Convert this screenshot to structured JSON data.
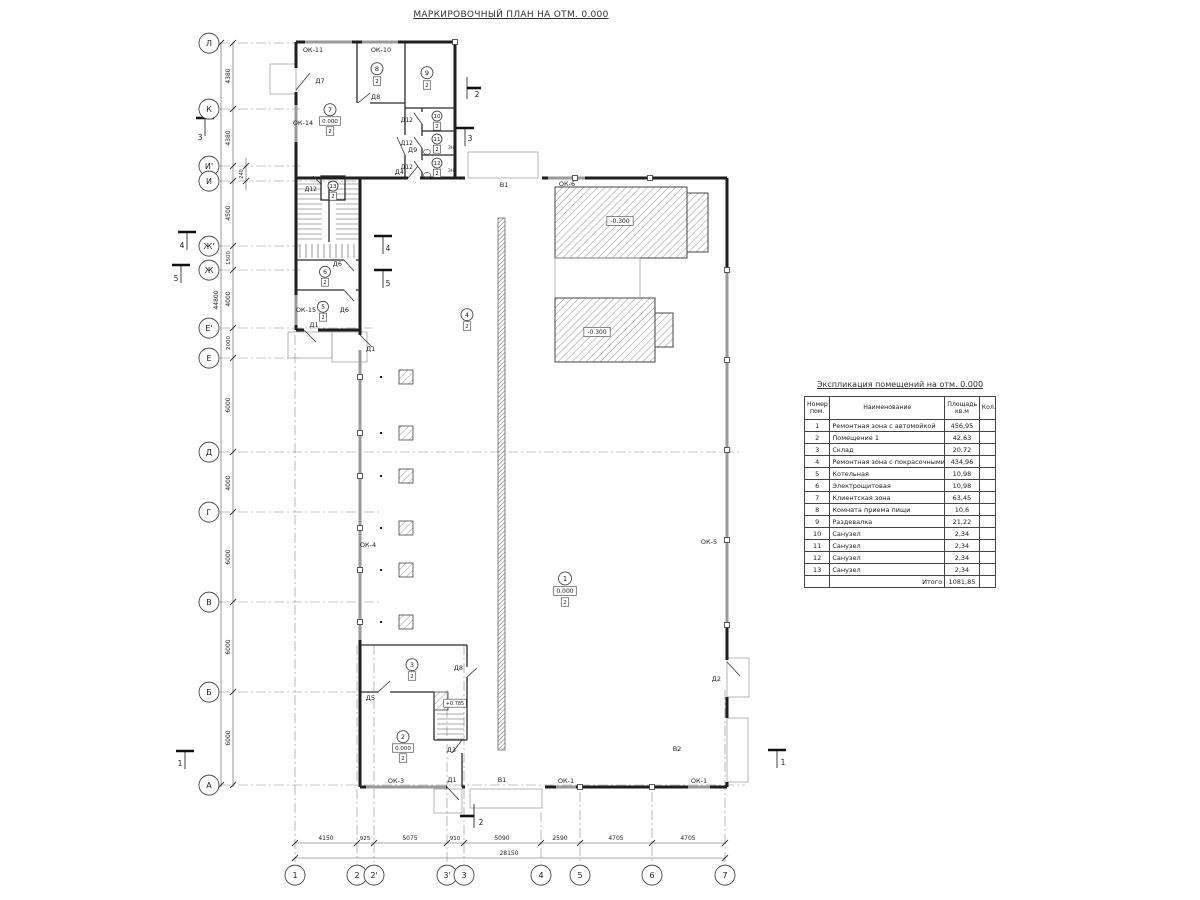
{
  "title": "МАРКИРОВОЧНЫЙ ПЛАН НА ОТМ. 0.000",
  "schedule": {
    "title": "Экспликация помещений на отм. 0.000",
    "headers": {
      "num1": "Номер",
      "num2": "пом.",
      "name": "Наименование",
      "area1": "Площадь",
      "area2": "кв.м",
      "qty": "Кол."
    },
    "rows": [
      {
        "num": "1",
        "name": "Ремонтная зона с автомойкой",
        "area": "456,95",
        "qty": ""
      },
      {
        "num": "2",
        "name": "Помещение 1",
        "area": "42,63",
        "qty": ""
      },
      {
        "num": "3",
        "name": "Склад",
        "area": "20,72",
        "qty": ""
      },
      {
        "num": "4",
        "name": "Ремонтная зона с покрасочными камерами",
        "area": "434,96",
        "qty": ""
      },
      {
        "num": "5",
        "name": "Котельная",
        "area": "10,98",
        "qty": ""
      },
      {
        "num": "6",
        "name": "Электрощитовая",
        "area": "10,98",
        "qty": ""
      },
      {
        "num": "7",
        "name": "Клиентская зона",
        "area": "63,45",
        "qty": ""
      },
      {
        "num": "8",
        "name": "Комната приема пищи",
        "area": "10,6",
        "qty": ""
      },
      {
        "num": "9",
        "name": "Раздевалка",
        "area": "21,22",
        "qty": ""
      },
      {
        "num": "10",
        "name": "Санузел",
        "area": "2,34",
        "qty": ""
      },
      {
        "num": "11",
        "name": "Санузел",
        "area": "2,34",
        "qty": ""
      },
      {
        "num": "12",
        "name": "Санузел",
        "area": "2,34",
        "qty": ""
      },
      {
        "num": "13",
        "name": "Санузел",
        "area": "2,34",
        "qty": ""
      }
    ],
    "total_label": "Итого",
    "total_value": "1081,85"
  },
  "plan": {
    "colors": {
      "wall": "#1f1f1f",
      "window": "#9a9a9a",
      "hatch": "#777"
    },
    "labels": [
      {
        "n": "axis-bubble-1",
        "t": "1",
        "x": 295,
        "y": 878,
        "r": 10,
        "fs": 8
      },
      {
        "n": "axis-bubble-2",
        "t": "2",
        "x": 357,
        "y": 878,
        "r": 10,
        "fs": 8
      },
      {
        "n": "axis-bubble-2p",
        "t": "2'",
        "x": 374,
        "y": 878,
        "r": 10,
        "fs": 8
      },
      {
        "n": "axis-bubble-3p",
        "t": "3'",
        "x": 447,
        "y": 878,
        "r": 10,
        "fs": 8
      },
      {
        "n": "axis-bubble-3",
        "t": "3",
        "x": 464,
        "y": 878,
        "r": 10,
        "fs": 8
      },
      {
        "n": "axis-bubble-4",
        "t": "4",
        "x": 541,
        "y": 878,
        "r": 10,
        "fs": 8
      },
      {
        "n": "axis-bubble-5",
        "t": "5",
        "x": 580,
        "y": 878,
        "r": 10,
        "fs": 8
      },
      {
        "n": "axis-bubble-6",
        "t": "6",
        "x": 652,
        "y": 878,
        "r": 10,
        "fs": 8
      },
      {
        "n": "axis-bubble-7",
        "t": "7",
        "x": 725,
        "y": 878,
        "r": 10,
        "fs": 8
      },
      {
        "n": "axis-bubble-L",
        "t": "Л",
        "x": 209,
        "y": 46,
        "r": 10,
        "fs": 8
      },
      {
        "n": "axis-bubble-K",
        "t": "К",
        "x": 209,
        "y": 112,
        "r": 10,
        "fs": 8
      },
      {
        "n": "axis-bubble-Ip",
        "t": "И'",
        "x": 209,
        "y": 169,
        "r": 10,
        "fs": 8
      },
      {
        "n": "axis-bubble-I",
        "t": "И",
        "x": 209,
        "y": 184,
        "r": 10,
        "fs": 8
      },
      {
        "n": "axis-bubble-Zhp",
        "t": "Ж'",
        "x": 209,
        "y": 249,
        "r": 10,
        "fs": 8
      },
      {
        "n": "axis-bubble-Zh",
        "t": "Ж",
        "x": 209,
        "y": 273,
        "r": 10,
        "fs": 8
      },
      {
        "n": "axis-bubble-Ep",
        "t": "Е'",
        "x": 209,
        "y": 331,
        "r": 10,
        "fs": 8
      },
      {
        "n": "axis-bubble-E",
        "t": "Е",
        "x": 209,
        "y": 361,
        "r": 10,
        "fs": 8
      },
      {
        "n": "axis-bubble-D",
        "t": "Д",
        "x": 209,
        "y": 455,
        "r": 10,
        "fs": 8
      },
      {
        "n": "axis-bubble-G",
        "t": "Г",
        "x": 209,
        "y": 515,
        "r": 10,
        "fs": 8
      },
      {
        "n": "axis-bubble-V",
        "t": "В",
        "x": 209,
        "y": 605,
        "r": 10,
        "fs": 8
      },
      {
        "n": "axis-bubble-B",
        "t": "Б",
        "x": 209,
        "y": 695,
        "r": 10,
        "fs": 8
      },
      {
        "n": "axis-bubble-A",
        "t": "А",
        "x": 209,
        "y": 788,
        "r": 10,
        "fs": 8
      },
      {
        "n": "dim-bottom",
        "t": "4150",
        "x": 326,
        "y": 840,
        "fs": 6
      },
      {
        "n": "dim-bottom",
        "t": "925",
        "x": 365,
        "y": 840,
        "fs": 5.5
      },
      {
        "n": "dim-bottom",
        "t": "5075",
        "x": 410,
        "y": 840,
        "fs": 6
      },
      {
        "n": "dim-bottom",
        "t": "910",
        "x": 455,
        "y": 840,
        "fs": 5.5
      },
      {
        "n": "dim-bottom",
        "t": "5090",
        "x": 502,
        "y": 840,
        "fs": 6
      },
      {
        "n": "dim-bottom",
        "t": "2590",
        "x": 560,
        "y": 840,
        "fs": 6
      },
      {
        "n": "dim-bottom",
        "t": "4705",
        "x": 616,
        "y": 840,
        "fs": 6
      },
      {
        "n": "dim-bottom",
        "t": "4705",
        "x": 688,
        "y": 840,
        "fs": 6
      },
      {
        "n": "dim-bottom-total",
        "t": "28150",
        "x": 509,
        "y": 855,
        "fs": 6
      },
      {
        "n": "dim-left",
        "t": "4380",
        "x": 230,
        "y": 76,
        "fs": 6,
        "rot": -90
      },
      {
        "n": "dim-left",
        "t": "4380",
        "x": 230,
        "y": 138,
        "fs": 6,
        "rot": -90
      },
      {
        "n": "dim-left",
        "t": "240",
        "x": 243,
        "y": 174,
        "fs": 5,
        "rot": -90
      },
      {
        "n": "dim-left",
        "t": "4500",
        "x": 230,
        "y": 213,
        "fs": 6,
        "rot": -90
      },
      {
        "n": "dim-left",
        "t": "1500",
        "x": 230,
        "y": 258,
        "fs": 5.5,
        "rot": -90
      },
      {
        "n": "dim-left",
        "t": "4000",
        "x": 230,
        "y": 299,
        "fs": 6,
        "rot": -90
      },
      {
        "n": "dim-left",
        "t": "2000",
        "x": 230,
        "y": 343,
        "fs": 5.5,
        "rot": -90
      },
      {
        "n": "dim-left",
        "t": "6000",
        "x": 230,
        "y": 405,
        "fs": 6,
        "rot": -90
      },
      {
        "n": "dim-left",
        "t": "4000",
        "x": 230,
        "y": 483,
        "fs": 6,
        "rot": -90
      },
      {
        "n": "dim-left",
        "t": "6000",
        "x": 230,
        "y": 557,
        "fs": 6,
        "rot": -90
      },
      {
        "n": "dim-left",
        "t": "6000",
        "x": 230,
        "y": 647,
        "fs": 6,
        "rot": -90
      },
      {
        "n": "dim-left",
        "t": "6000",
        "x": 230,
        "y": 738,
        "fs": 6,
        "rot": -90
      },
      {
        "n": "dim-left-total",
        "t": "44800",
        "x": 218,
        "y": 300,
        "fs": 6,
        "rot": -90
      },
      {
        "n": "room-marker-7",
        "t": "7",
        "x": 330,
        "y": 112,
        "r": 6,
        "fs": 6.5
      },
      {
        "n": "elevation-mark",
        "t": "0.000",
        "x": 330,
        "y": 123,
        "b": 1,
        "fs": 5.5
      },
      {
        "n": "finish-tag",
        "t": "2",
        "x": 330,
        "y": 133,
        "b": 1,
        "fs": 5.5
      },
      {
        "n": "room-marker-8",
        "t": "8",
        "x": 377,
        "y": 71,
        "r": 6,
        "fs": 6.5
      },
      {
        "n": "finish-tag",
        "t": "2",
        "x": 377,
        "y": 83,
        "b": 1,
        "fs": 5.5
      },
      {
        "n": "room-marker-9",
        "t": "9",
        "x": 427,
        "y": 75,
        "r": 6,
        "fs": 6.5
      },
      {
        "n": "finish-tag",
        "t": "2",
        "x": 427,
        "y": 87,
        "b": 1,
        "fs": 5.5
      },
      {
        "n": "room-marker-10",
        "t": "10",
        "x": 437,
        "y": 118,
        "r": 5,
        "fs": 5.5
      },
      {
        "n": "finish-tag",
        "t": "2",
        "x": 437,
        "y": 128,
        "b": 1,
        "fs": 5
      },
      {
        "n": "room-marker-11",
        "t": "11",
        "x": 437,
        "y": 141,
        "r": 5,
        "fs": 5.5
      },
      {
        "n": "finish-tag",
        "t": "2",
        "x": 437,
        "y": 151,
        "b": 1,
        "fs": 5
      },
      {
        "n": "room-marker-12",
        "t": "12",
        "x": 437,
        "y": 165,
        "r": 5,
        "fs": 5.5
      },
      {
        "n": "finish-tag",
        "t": "2",
        "x": 437,
        "y": 175,
        "b": 1,
        "fs": 5
      },
      {
        "n": "room-marker-13",
        "t": "13",
        "x": 333,
        "y": 188,
        "r": 5,
        "fs": 5.5
      },
      {
        "n": "finish-tag",
        "t": "2",
        "x": 333,
        "y": 198,
        "b": 1,
        "fs": 5
      },
      {
        "n": "room-marker-6",
        "t": "6",
        "x": 325,
        "y": 274,
        "r": 5.5,
        "fs": 6
      },
      {
        "n": "finish-tag",
        "t": "2",
        "x": 325,
        "y": 284,
        "b": 1,
        "fs": 5
      },
      {
        "n": "room-marker-5",
        "t": "5",
        "x": 323,
        "y": 309,
        "r": 5.5,
        "fs": 6
      },
      {
        "n": "finish-tag",
        "t": "2",
        "x": 323,
        "y": 319,
        "b": 1,
        "fs": 5
      },
      {
        "n": "room-marker-4",
        "t": "4",
        "x": 467,
        "y": 317,
        "r": 6,
        "fs": 6.5
      },
      {
        "n": "finish-tag",
        "t": "2",
        "x": 467,
        "y": 328,
        "b": 1,
        "fs": 5.5
      },
      {
        "n": "room-marker-3",
        "t": "3",
        "x": 412,
        "y": 667,
        "r": 6,
        "fs": 6.5
      },
      {
        "n": "finish-tag",
        "t": "2",
        "x": 412,
        "y": 678,
        "b": 1,
        "fs": 5.5
      },
      {
        "n": "room-marker-2",
        "t": "2",
        "x": 403,
        "y": 739,
        "r": 6,
        "fs": 6.5
      },
      {
        "n": "elevation-mark",
        "t": "0.000",
        "x": 403,
        "y": 750,
        "b": 1,
        "fs": 5.5
      },
      {
        "n": "finish-tag",
        "t": "2",
        "x": 403,
        "y": 760,
        "b": 1,
        "fs": 5.5
      },
      {
        "n": "room-marker-1",
        "t": "1",
        "x": 565,
        "y": 581,
        "r": 6.5,
        "fs": 7
      },
      {
        "n": "elevation-mark",
        "t": "0.000",
        "x": 565,
        "y": 593,
        "b": 1,
        "fs": 6
      },
      {
        "n": "finish-tag",
        "t": "2",
        "x": 565,
        "y": 604,
        "b": 1,
        "fs": 5.5
      },
      {
        "n": "elevation-mark",
        "t": "-0.300",
        "x": 620,
        "y": 223,
        "b": 1,
        "fs": 6
      },
      {
        "n": "elevation-mark",
        "t": "-0.300",
        "x": 597,
        "y": 334,
        "b": 1,
        "fs": 6
      },
      {
        "n": "elevation-mark",
        "t": "+0.785",
        "x": 455,
        "y": 705,
        "b": 1,
        "fs": 5
      },
      {
        "n": "window-label",
        "t": "ОК-11",
        "x": 313,
        "y": 52,
        "fs": 6.5
      },
      {
        "n": "window-label",
        "t": "ОК-10",
        "x": 381,
        "y": 52,
        "fs": 6.5
      },
      {
        "n": "window-label",
        "t": "ОК-14",
        "x": 303,
        "y": 125,
        "fs": 6.5
      },
      {
        "n": "window-label",
        "t": "ОК-15",
        "x": 306,
        "y": 312,
        "fs": 6.5
      },
      {
        "n": "window-label",
        "t": "ОК-6",
        "x": 567,
        "y": 186,
        "fs": 6.5
      },
      {
        "n": "window-label",
        "t": "ОК-4",
        "x": 368,
        "y": 547,
        "fs": 6.5
      },
      {
        "n": "window-label",
        "t": "ОК-5",
        "x": 709,
        "y": 544,
        "fs": 6.5
      },
      {
        "n": "window-label",
        "t": "ОК-3",
        "x": 396,
        "y": 783,
        "fs": 6.5
      },
      {
        "n": "window-label",
        "t": "ОК-1",
        "x": 566,
        "y": 783,
        "fs": 6.5
      },
      {
        "n": "window-label",
        "t": "ОК-1",
        "x": 699,
        "y": 783,
        "fs": 6.5
      },
      {
        "n": "gate-label",
        "t": "В1",
        "x": 504,
        "y": 187,
        "fs": 6.5
      },
      {
        "n": "gate-label",
        "t": "В1",
        "x": 502,
        "y": 782,
        "fs": 6.5
      },
      {
        "n": "gate-label",
        "t": "В2",
        "x": 677,
        "y": 751,
        "fs": 6.5
      },
      {
        "n": "door-label",
        "t": "Д2",
        "x": 721,
        "y": 681,
        "a": "e",
        "fs": 6.5
      },
      {
        "n": "door-label",
        "t": "Д7",
        "x": 320,
        "y": 83,
        "fs": 6.5
      },
      {
        "n": "door-label",
        "t": "Д8",
        "x": 371,
        "y": 99,
        "a": "s",
        "fs": 6.5
      },
      {
        "n": "door-label",
        "t": "Д9",
        "x": 408,
        "y": 152,
        "a": "s",
        "fs": 6.5
      },
      {
        "n": "door-label",
        "t": "Д4",
        "x": 404,
        "y": 174,
        "a": "e",
        "fs": 6.5
      },
      {
        "n": "door-label",
        "t": "Д12",
        "x": 413,
        "y": 122,
        "a": "e",
        "fs": 6
      },
      {
        "n": "door-label",
        "t": "Д12",
        "x": 413,
        "y": 145,
        "a": "e",
        "fs": 6
      },
      {
        "n": "door-label",
        "t": "Д12",
        "x": 413,
        "y": 169,
        "a": "e",
        "fs": 6
      },
      {
        "n": "door-label",
        "t": "Д12",
        "x": 317,
        "y": 191,
        "a": "e",
        "fs": 6
      },
      {
        "n": "door-label",
        "t": "Д6",
        "x": 342,
        "y": 266,
        "a": "e",
        "fs": 6.5
      },
      {
        "n": "door-label",
        "t": "Д6",
        "x": 349,
        "y": 312,
        "a": "e",
        "fs": 6.5
      },
      {
        "n": "door-label",
        "t": "Д1",
        "x": 314,
        "y": 327,
        "fs": 6.5
      },
      {
        "n": "door-label",
        "t": "Д1",
        "x": 366,
        "y": 351,
        "a": "s",
        "fs": 6.5
      },
      {
        "n": "door-label",
        "t": "Д1",
        "x": 452,
        "y": 782,
        "fs": 6.5
      },
      {
        "n": "door-label",
        "t": "Д5",
        "x": 375,
        "y": 700,
        "a": "e",
        "fs": 6.5
      },
      {
        "n": "door-label",
        "t": "Д8",
        "x": 463,
        "y": 670,
        "a": "e",
        "fs": 6.5
      },
      {
        "n": "door-label",
        "t": "Д3",
        "x": 456,
        "y": 752,
        "a": "e",
        "fs": 6.5
      },
      {
        "n": "vent-mark",
        "t": "ЗН",
        "x": 451,
        "y": 149,
        "fs": 4.5
      },
      {
        "n": "vent-mark",
        "t": "ЗН",
        "x": 451,
        "y": 172,
        "fs": 4.5
      },
      {
        "n": "section-flag-3",
        "t": "3",
        "x": 200,
        "y": 140,
        "fs": 7.5
      },
      {
        "n": "section-flag-3",
        "t": "3",
        "x": 470,
        "y": 141,
        "fs": 7.5
      },
      {
        "n": "section-flag-2",
        "t": "2",
        "x": 477,
        "y": 97,
        "fs": 7.5
      },
      {
        "n": "section-flag-2",
        "t": "2",
        "x": 481,
        "y": 825,
        "fs": 7.5
      },
      {
        "n": "section-flag-4",
        "t": "4",
        "x": 182,
        "y": 248,
        "fs": 7.5
      },
      {
        "n": "section-flag-4",
        "t": "4",
        "x": 388,
        "y": 251,
        "fs": 7.5
      },
      {
        "n": "section-flag-5",
        "t": "5",
        "x": 176,
        "y": 281,
        "fs": 7.5
      },
      {
        "n": "section-flag-5",
        "t": "5",
        "x": 388,
        "y": 286,
        "fs": 7.5
      },
      {
        "n": "section-flag-1",
        "t": "1",
        "x": 180,
        "y": 766,
        "fs": 7.5
      },
      {
        "n": "section-flag-1",
        "t": "1",
        "x": 783,
        "y": 765,
        "fs": 7.5
      }
    ]
  }
}
